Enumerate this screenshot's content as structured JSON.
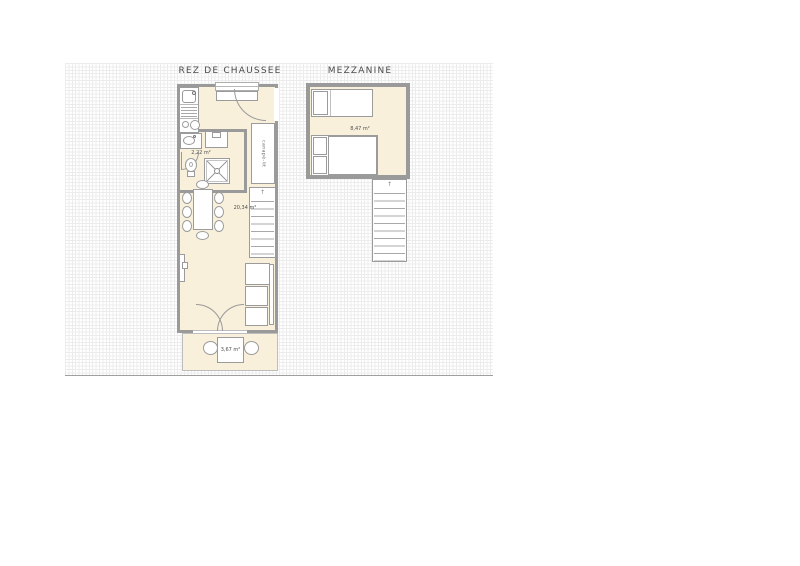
{
  "titles": {
    "ground_floor": "REZ DE CHAUSSEE",
    "mezzanine": "MEZZANINE"
  },
  "labels": {
    "bathroom_area": "2,22 m²",
    "living_area": "20,34 m²",
    "terrace_area": "3,67 m²",
    "mezzanine_area": "8,47 m²",
    "cabinet": "canapé-lit",
    "stairs_up_arrow": "↑"
  },
  "colors": {
    "wall": "#9a9a9a",
    "floor_fill": "#f8f0db",
    "furniture_outline": "#9b9b9b",
    "grid_minor": "#ececec",
    "grid_major": "#dcdcdc",
    "title_text": "#4a4a4a",
    "label_text": "#4f4f4f"
  }
}
